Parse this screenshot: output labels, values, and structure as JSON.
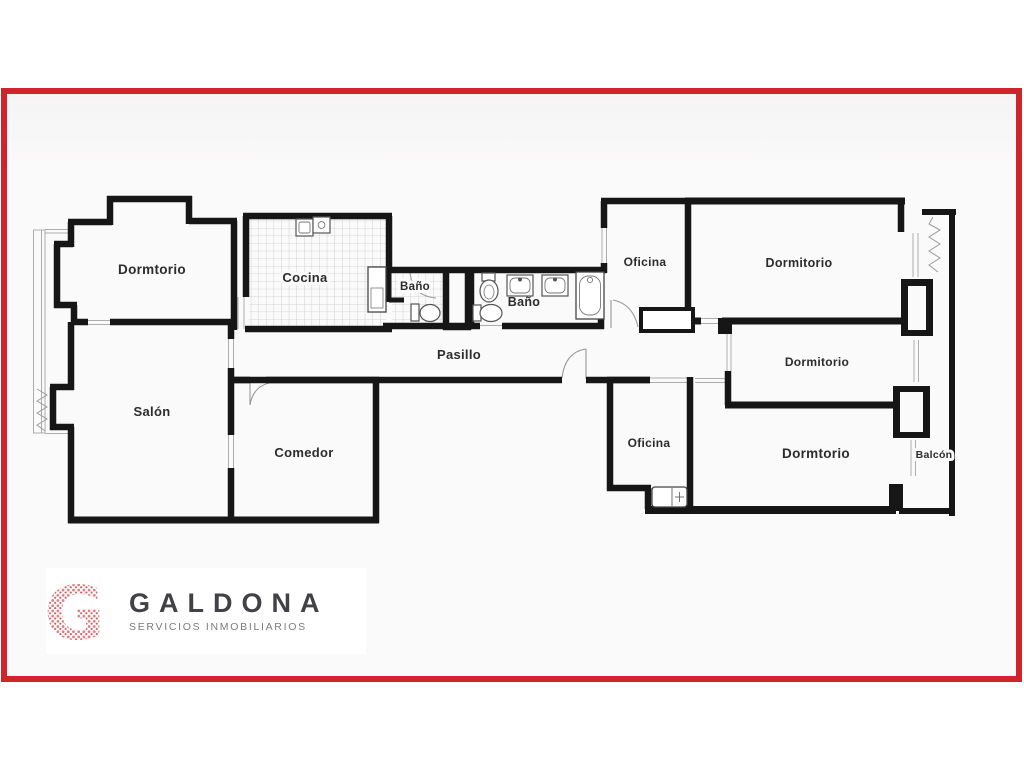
{
  "frame": {
    "border_color": "#d0242d",
    "background": "#fbfafa"
  },
  "plan": {
    "ink_color": "#161616",
    "labels": {
      "dormitorio_top_left": "Dormtorio",
      "cocina": "Cocina",
      "bano_small": "Baño",
      "bano_large": "Baño",
      "pasillo": "Pasillo",
      "oficina_top": "Oficina",
      "dormitorio_top_right": "Dormitorio",
      "dormitorio_mid_right": "Dormitorio",
      "salon": "Salón",
      "comedor": "Comedor",
      "oficina_bottom": "Oficina",
      "dormitorio_bottom_right": "Dormtorio",
      "balcon": "Balcón"
    }
  },
  "logo": {
    "monogram": "G",
    "name": "GALDONA",
    "tagline": "SERVICIOS INMOBILIARIOS",
    "accent_color": "#dd7d80",
    "name_color": "#424246",
    "tagline_color": "#7b7b7e"
  }
}
